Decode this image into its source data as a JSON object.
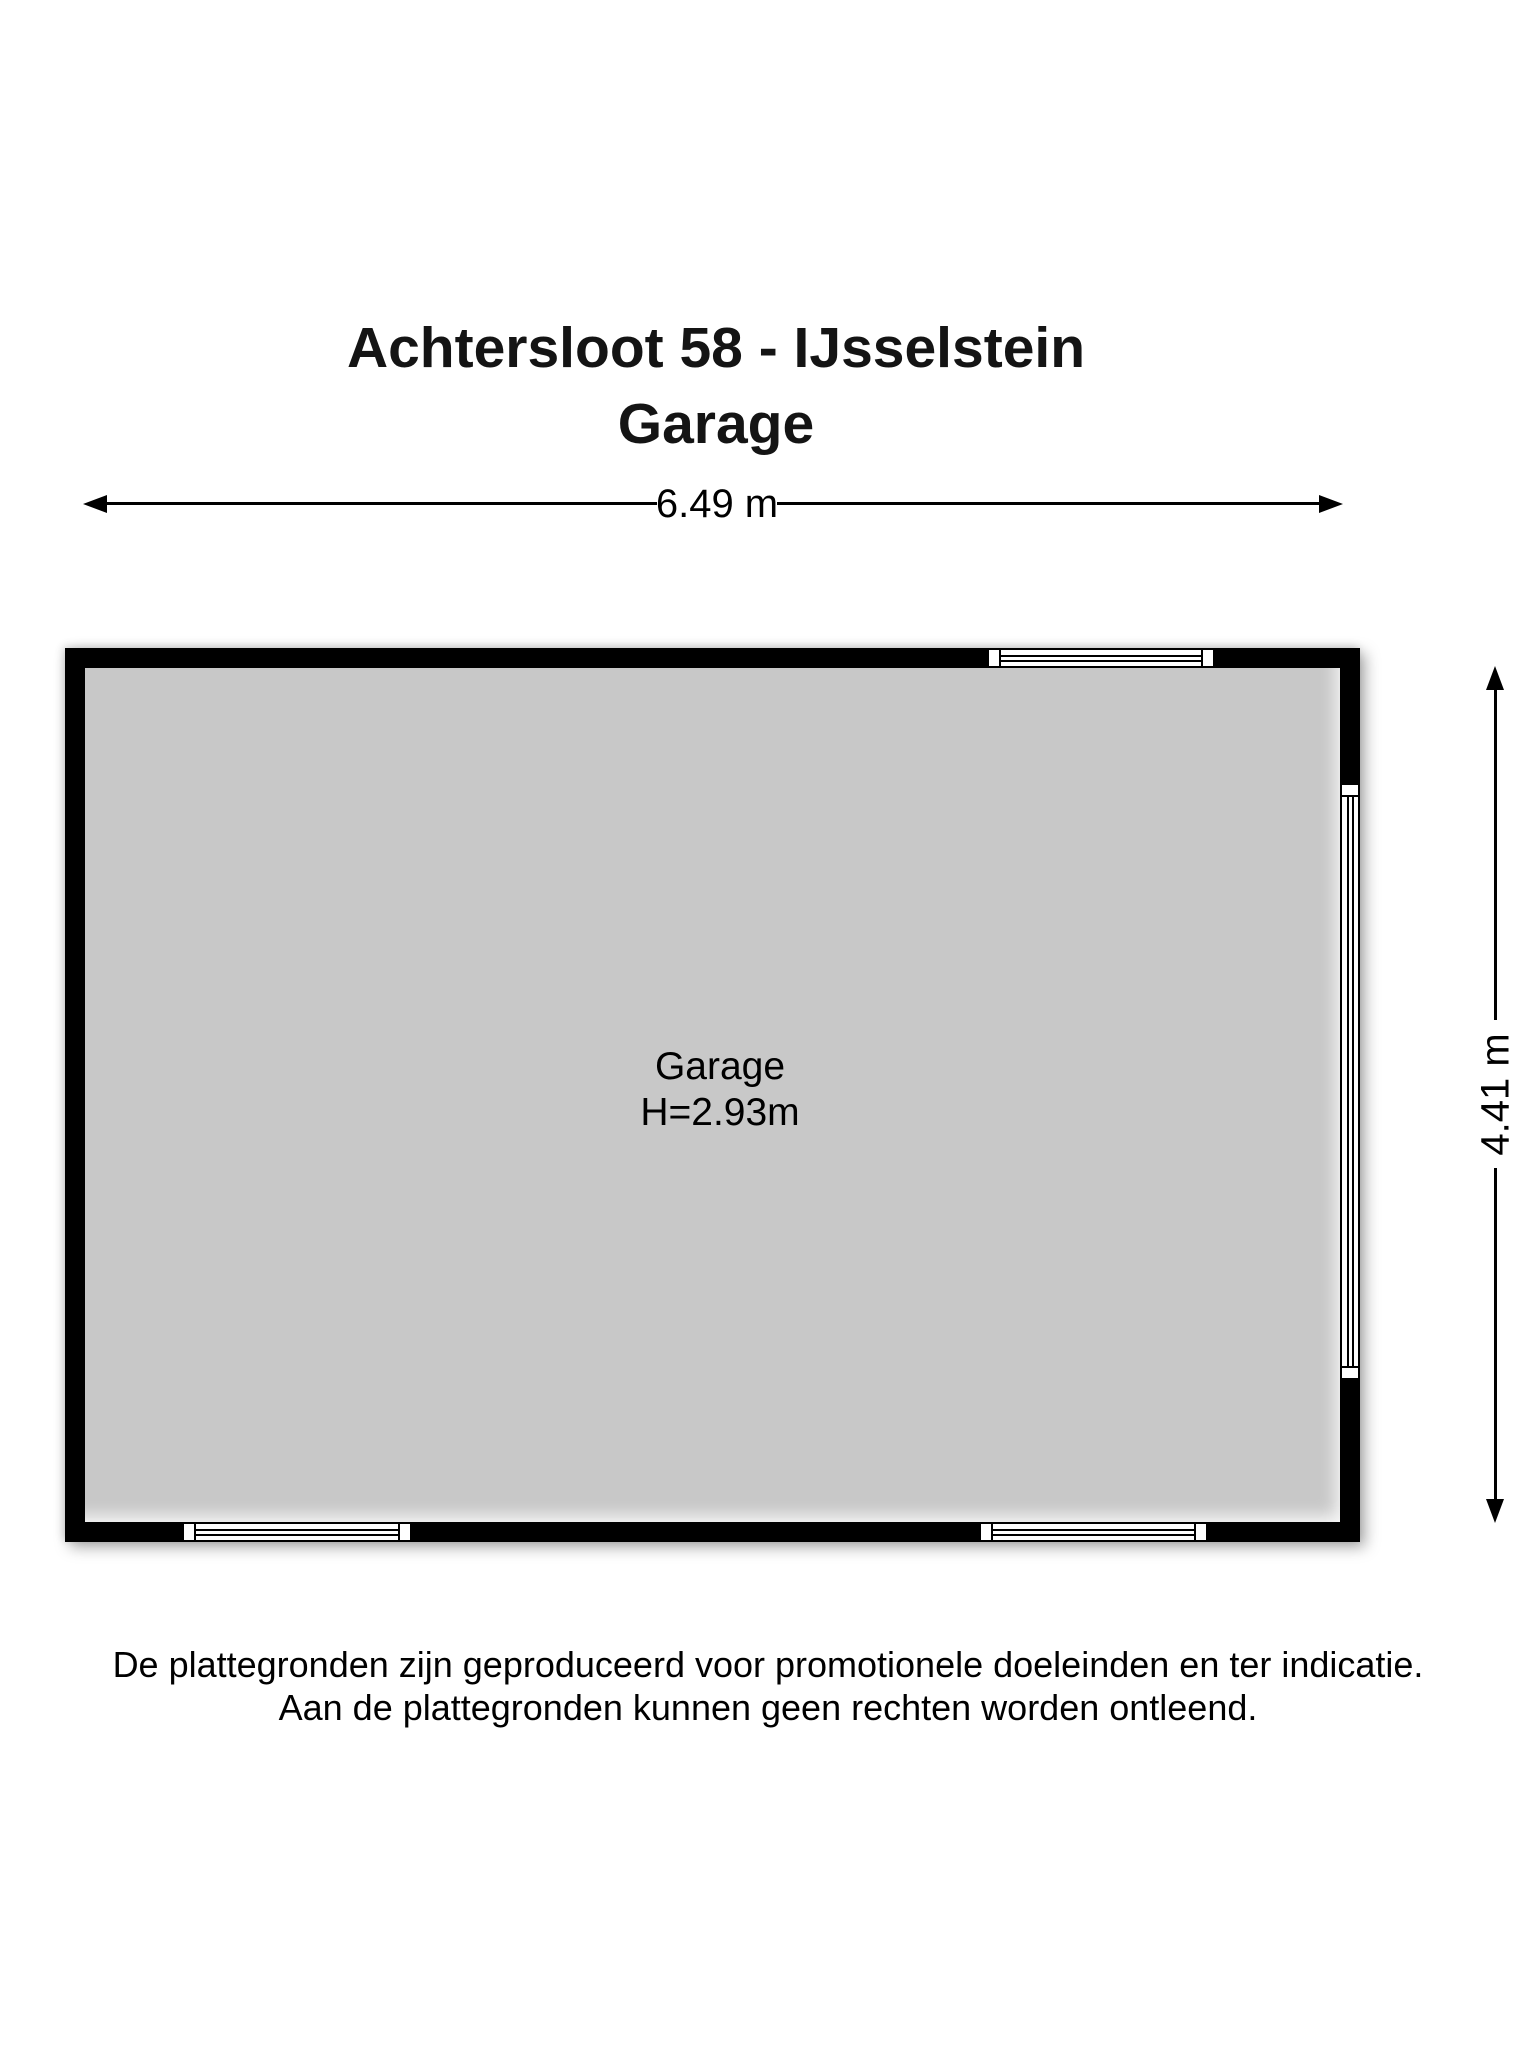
{
  "title": {
    "line1": "Achtersloot 58 - IJsselstein",
    "line2": "Garage"
  },
  "dimensions": {
    "width_label": "6.49 m",
    "height_label": "4.41 m"
  },
  "room": {
    "name": "Garage",
    "height_label": "H=2.93m"
  },
  "disclaimer": {
    "line1": "De plattegronden zijn geproduceerd voor promotionele doeleinden en ter indicatie.",
    "line2": "Aan de plattegronden kunnen geen rechten worden ontleend."
  },
  "colors": {
    "wall": "#000000",
    "floor": "#c8c8c8",
    "background": "#ffffff",
    "text": "#000000"
  }
}
